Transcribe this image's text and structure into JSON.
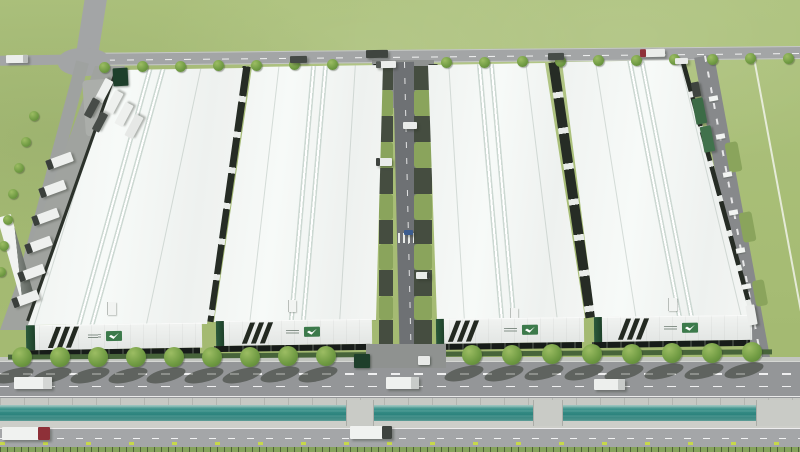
{
  "meta": {
    "title": "Aerial 3D rendering of an industrial logistics park",
    "description": "Bird's-eye architectural rendering: four long white-roofed warehouse buildings with dark stripe and green logo branding on their front facades, internal dock roads with grass verges and loading bays, a tree-lined boulevard, a teal water canal, a second frontage road, and perimeter roads with trucks on a green grass field.",
    "canvas_width": 800,
    "canvas_height": 452,
    "buildings_count": 4
  },
  "palette": {
    "grass": "#a9bf78",
    "road_gray": "#a3a5a6",
    "road_dark": "#6e7174",
    "roof_white": "#f4f6f4",
    "facade_white": "#e9ece9",
    "stripe_dark": "#232921",
    "brand_green": "#3c7a4b",
    "gate_green": "#1e3f2b",
    "dock_dark": "#171c19",
    "hedge_green": "#47643a",
    "verge_olive": "#8aa45c",
    "apron_gray_green": "#454d40",
    "canal_teal": "#2c837d",
    "concrete": "#c7c9c4",
    "tree_green": "#6f9a42",
    "marker_yellow_green": "#c6d84b",
    "truck_red_cab": "#8e3038",
    "container_green": "#3c6b46",
    "car_blue": "#3c5d8f"
  },
  "buildings": [
    {
      "roof": {
        "x": 28,
        "y": 66,
        "w": 218,
        "h": 262,
        "poly": [
          [
            90,
            4
          ],
          [
            215,
            2
          ],
          [
            179,
            258
          ],
          [
            0,
            259
          ]
        ]
      },
      "ridges": [
        {
          "left": 84,
          "angle": 15.5
        },
        {
          "left": 97,
          "angle": 15.5
        }
      ],
      "seams": [
        {
          "left": 45,
          "angle": 17
        },
        {
          "left": 145,
          "angle": 12
        }
      ],
      "unit": {
        "x": 79,
        "y": 236,
        "w": 8,
        "h": 13
      },
      "facade": {
        "x": 26,
        "y": 324,
        "w": 176,
        "h": 25,
        "angle": -0.9,
        "corner_w": 9,
        "stripes_left": 26,
        "logo_left": 62
      },
      "dock": {
        "x": 24,
        "y": 349,
        "w": 176,
        "h": 6,
        "angle": -0.9
      }
    },
    {
      "roof": {
        "x": 212,
        "y": 63,
        "w": 172,
        "h": 260,
        "poly": [
          [
            40,
            4
          ],
          [
            171,
            2
          ],
          [
            164,
            257
          ],
          [
            2,
            259
          ]
        ]
      },
      "ridges": [
        {
          "left": 88,
          "angle": 5
        },
        {
          "left": 100,
          "angle": 5
        }
      ],
      "seams": [
        {
          "left": 52,
          "angle": 6.5
        },
        {
          "left": 135,
          "angle": 3.5
        }
      ],
      "unit": {
        "x": 76,
        "y": 237,
        "w": 7,
        "h": 12
      },
      "facade": {
        "x": 216,
        "y": 320,
        "w": 156,
        "h": 25,
        "angle": -0.8,
        "corner_w": 8,
        "stripes_left": 30,
        "logo_left": 70
      },
      "dock": {
        "x": 214,
        "y": 345,
        "w": 156,
        "h": 6,
        "angle": -0.8
      }
    },
    {
      "roof": {
        "x": 426,
        "y": 61,
        "w": 162,
        "h": 260,
        "poly": [
          [
            2,
            4
          ],
          [
            119,
            2
          ],
          [
            159,
            257
          ],
          [
            11,
            259
          ]
        ]
      },
      "ridges": [
        {
          "left": 62,
          "angle": -5
        },
        {
          "left": 74,
          "angle": -5
        }
      ],
      "seams": [
        {
          "left": 30,
          "angle": -3.5
        },
        {
          "left": 115,
          "angle": -7
        }
      ],
      "unit": {
        "x": 84,
        "y": 247,
        "w": 7,
        "h": 14
      },
      "facade": {
        "x": 436,
        "y": 318,
        "w": 148,
        "h": 25,
        "angle": -0.8,
        "corner_w": 8,
        "stripes_left": 16,
        "logo_left": 68
      },
      "dock": {
        "x": 434,
        "y": 343,
        "w": 148,
        "h": 6,
        "angle": -0.8
      }
    },
    {
      "roof": {
        "x": 560,
        "y": 56,
        "w": 196,
        "h": 264,
        "poly": [
          [
            2,
            6
          ],
          [
            120,
            4
          ],
          [
            190,
            260
          ],
          [
            35,
            262
          ]
        ]
      },
      "ridges": [
        {
          "left": 92,
          "angle": -11
        },
        {
          "left": 104,
          "angle": -11
        }
      ],
      "seams": [
        {
          "left": 55,
          "angle": -9
        },
        {
          "left": 150,
          "angle": -13.5
        }
      ],
      "unit": {
        "x": 108,
        "y": 242,
        "w": 8,
        "h": 13
      },
      "facade": {
        "x": 594,
        "y": 316,
        "w": 158,
        "h": 25,
        "angle": -0.8,
        "corner_w": 8,
        "stripes_left": 28,
        "logo_left": 70
      },
      "dock": {
        "x": 592,
        "y": 341,
        "w": 158,
        "h": 6,
        "angle": -0.8
      }
    }
  ],
  "strips": [
    {
      "x": 70,
      "y": 65,
      "w": 6,
      "h": 264,
      "a": 19.5,
      "striped": false
    },
    {
      "x": 224,
      "y": 65,
      "w": 8,
      "h": 258,
      "a": 8.3,
      "striped": true
    },
    {
      "x": 370,
      "y": 64,
      "w": 9,
      "h": 256,
      "a": 1.5,
      "striped": true
    },
    {
      "x": 433,
      "y": 64,
      "w": 9,
      "h": 256,
      "a": -2,
      "striped": true
    },
    {
      "x": 567,
      "y": 61,
      "w": 10,
      "h": 258,
      "a": -8.3,
      "striped": true
    },
    {
      "x": 714,
      "y": 58,
      "w": 6,
      "h": 262,
      "a": -15.3,
      "striped": true
    }
  ],
  "central": {
    "bays": [
      {
        "y": 66,
        "h": 24,
        "t": "a"
      },
      {
        "y": 90,
        "h": 26,
        "t": "g"
      },
      {
        "y": 116,
        "h": 26,
        "t": "a"
      },
      {
        "y": 142,
        "h": 26,
        "t": "g"
      },
      {
        "y": 168,
        "h": 26,
        "t": "a"
      },
      {
        "y": 194,
        "h": 26,
        "t": "g"
      },
      {
        "y": 220,
        "h": 24,
        "t": "a"
      },
      {
        "y": 244,
        "h": 26,
        "t": "g"
      },
      {
        "y": 270,
        "h": 26,
        "t": "a"
      },
      {
        "y": 296,
        "h": 24,
        "t": "g"
      },
      {
        "y": 320,
        "h": 25,
        "t": "a"
      }
    ],
    "bay_left": {
      "x": 379,
      "w": 14
    },
    "bay_right": {
      "x": 414,
      "w": 18
    }
  },
  "right_bays": [
    {
      "x": 727,
      "y": 142,
      "w": 13,
      "h": 30
    },
    {
      "x": 741,
      "y": 212,
      "w": 13,
      "h": 30
    },
    {
      "x": 754,
      "y": 280,
      "w": 12,
      "h": 26
    }
  ],
  "right_canopies": [
    {
      "x": 709,
      "y": 96
    },
    {
      "x": 716,
      "y": 134
    },
    {
      "x": 723,
      "y": 172
    },
    {
      "x": 729,
      "y": 210
    },
    {
      "x": 736,
      "y": 248
    },
    {
      "x": 742,
      "y": 284
    }
  ],
  "trees": {
    "top": {
      "r": 5.5,
      "pts": [
        [
          104,
          67
        ],
        [
          142,
          66
        ],
        [
          180,
          66
        ],
        [
          218,
          65
        ],
        [
          256,
          65
        ],
        [
          294,
          64
        ],
        [
          332,
          64
        ],
        [
          446,
          62
        ],
        [
          484,
          62
        ],
        [
          522,
          61
        ],
        [
          560,
          61
        ],
        [
          598,
          60
        ],
        [
          636,
          60
        ],
        [
          674,
          59
        ],
        [
          712,
          59
        ],
        [
          750,
          58
        ],
        [
          788,
          58
        ]
      ]
    },
    "west": {
      "r": 5,
      "pts": [
        [
          34,
          116
        ],
        [
          26,
          142
        ],
        [
          19,
          168
        ],
        [
          13,
          194
        ],
        [
          8,
          220
        ],
        [
          4,
          246
        ],
        [
          1,
          272
        ]
      ]
    },
    "boulevard": {
      "r": 10,
      "shadow": true,
      "pts": [
        [
          22,
          357
        ],
        [
          60,
          357
        ],
        [
          98,
          357
        ],
        [
          136,
          357
        ],
        [
          174,
          357
        ],
        [
          212,
          357
        ],
        [
          250,
          357
        ],
        [
          288,
          356
        ],
        [
          326,
          356
        ],
        [
          472,
          355
        ],
        [
          512,
          355
        ],
        [
          552,
          354
        ],
        [
          592,
          354
        ],
        [
          632,
          354
        ],
        [
          672,
          353
        ],
        [
          712,
          353
        ],
        [
          752,
          352
        ]
      ]
    }
  },
  "trucks": [
    {
      "x": 6,
      "y": 55,
      "w": 22,
      "h": 8,
      "a": -1,
      "c": "#eceeec",
      "k": "#b9bcba",
      "s": "right"
    },
    {
      "x": 290,
      "y": 56,
      "w": 17,
      "h": 7,
      "a": -1,
      "c": "#454a46"
    },
    {
      "x": 366,
      "y": 50,
      "w": 22,
      "h": 8,
      "a": -1,
      "c": "#3f443f"
    },
    {
      "x": 376,
      "y": 61,
      "w": 20,
      "h": 7,
      "a": -1,
      "c": "#eceeec",
      "k": "#555a56",
      "s": "left"
    },
    {
      "x": 548,
      "y": 53,
      "w": 16,
      "h": 7,
      "a": -1,
      "c": "#474c48"
    },
    {
      "x": 640,
      "y": 49,
      "w": 25,
      "h": 8,
      "a": -1,
      "c": "#eaece9",
      "k": "#8e3038",
      "s": "left"
    },
    {
      "x": 675,
      "y": 58,
      "w": 13,
      "h": 6,
      "a": -1,
      "c": "#e9ebe9"
    },
    {
      "x": 692,
      "y": 82,
      "w": 8,
      "h": 15,
      "a": -11,
      "c": "#3f443f"
    },
    {
      "n": "container-trailer",
      "x": 694,
      "y": 98,
      "w": 11,
      "h": 26,
      "a": -11,
      "c": "#3c6b46"
    },
    {
      "n": "container-trailer",
      "x": 702,
      "y": 126,
      "w": 11,
      "h": 26,
      "a": -11,
      "c": "#41724c"
    },
    {
      "x": 46,
      "y": 156,
      "w": 27,
      "h": 10,
      "a": -20,
      "c": "#eef0ee",
      "k": "#3a3f3b",
      "s": "left"
    },
    {
      "x": 39,
      "y": 184,
      "w": 27,
      "h": 10,
      "a": -20,
      "c": "#eef0ee",
      "k": "#3a3f3b",
      "s": "left"
    },
    {
      "x": 32,
      "y": 212,
      "w": 27,
      "h": 10,
      "a": -20,
      "c": "#eef0ee",
      "k": "#3a3f3b",
      "s": "left"
    },
    {
      "x": 25,
      "y": 240,
      "w": 27,
      "h": 10,
      "a": -20,
      "c": "#eef0ee",
      "k": "#3a3f3b",
      "s": "left"
    },
    {
      "x": 18,
      "y": 268,
      "w": 27,
      "h": 10,
      "a": -20,
      "c": "#eef0ee",
      "k": "#3a3f3b",
      "s": "left"
    },
    {
      "x": 12,
      "y": 294,
      "w": 27,
      "h": 10,
      "a": -20,
      "c": "#eef0ee",
      "k": "#3a3f3b",
      "s": "left"
    },
    {
      "x": 92,
      "y": 86,
      "w": 24,
      "h": 9,
      "a": -62,
      "c": "#eef0ee"
    },
    {
      "x": 102,
      "y": 98,
      "w": 24,
      "h": 9,
      "a": -62,
      "c": "#eef0ee"
    },
    {
      "x": 112,
      "y": 110,
      "w": 24,
      "h": 9,
      "a": -62,
      "c": "#eef0ee"
    },
    {
      "x": 122,
      "y": 122,
      "w": 24,
      "h": 9,
      "a": -62,
      "c": "#e6e8e6"
    },
    {
      "x": 82,
      "y": 104,
      "w": 20,
      "h": 8,
      "a": -62,
      "c": "#474c48"
    },
    {
      "x": 90,
      "y": 118,
      "w": 20,
      "h": 8,
      "a": -62,
      "c": "#474c48"
    },
    {
      "x": 14,
      "y": 377,
      "w": 38,
      "h": 12,
      "a": 0,
      "c": "#eff1ef",
      "k": "#d4d6d4",
      "s": "right"
    },
    {
      "x": 386,
      "y": 377,
      "w": 33,
      "h": 12,
      "a": 0,
      "c": "#eff1ef",
      "k": "#c8cbc9",
      "s": "right"
    },
    {
      "x": 594,
      "y": 379,
      "w": 31,
      "h": 11,
      "a": 0,
      "c": "#edefed",
      "k": "#c8cbc9",
      "s": "right"
    },
    {
      "x": 747,
      "y": 305,
      "w": 9,
      "h": 20,
      "a": -10,
      "c": "#eceeec"
    },
    {
      "x": 2,
      "y": 427,
      "w": 48,
      "h": 13,
      "a": 0,
      "c": "#f0f2f0",
      "k": "#8e3038",
      "s": "right"
    },
    {
      "x": 350,
      "y": 426,
      "w": 42,
      "h": 13,
      "a": 0,
      "c": "#f0f2f0",
      "k": "#3e433f",
      "s": "right"
    },
    {
      "x": 376,
      "y": 158,
      "w": 16,
      "h": 8,
      "a": 0,
      "c": "#e9ebe9",
      "k": "#3e433f",
      "s": "left"
    },
    {
      "x": 403,
      "y": 122,
      "w": 14,
      "h": 7,
      "a": 0,
      "c": "#e9ebe9"
    },
    {
      "x": 416,
      "y": 272,
      "w": 14,
      "h": 7,
      "a": 0,
      "c": "#e9ebe9",
      "k": "#3e433f",
      "s": "right"
    },
    {
      "n": "car",
      "x": 404,
      "y": 230,
      "w": 9,
      "h": 5,
      "a": 0,
      "c": "#3c5d8f"
    }
  ],
  "bridges": [
    {
      "x": 346,
      "w": 26
    },
    {
      "x": 533,
      "w": 28
    },
    {
      "x": 756,
      "w": 44
    }
  ],
  "structures": [
    {
      "n": "gatehouse",
      "x": 113,
      "y": 68,
      "w": 15,
      "h": 18,
      "a": -3,
      "c": "#1e3f2b"
    },
    {
      "n": "gatehouse",
      "x": 354,
      "y": 354,
      "w": 16,
      "h": 14,
      "a": 0,
      "c": "#1e3f2b"
    },
    {
      "n": "security-booth",
      "x": 418,
      "y": 356,
      "w": 12,
      "h": 9,
      "a": 0,
      "c": "#e8eae8"
    }
  ]
}
